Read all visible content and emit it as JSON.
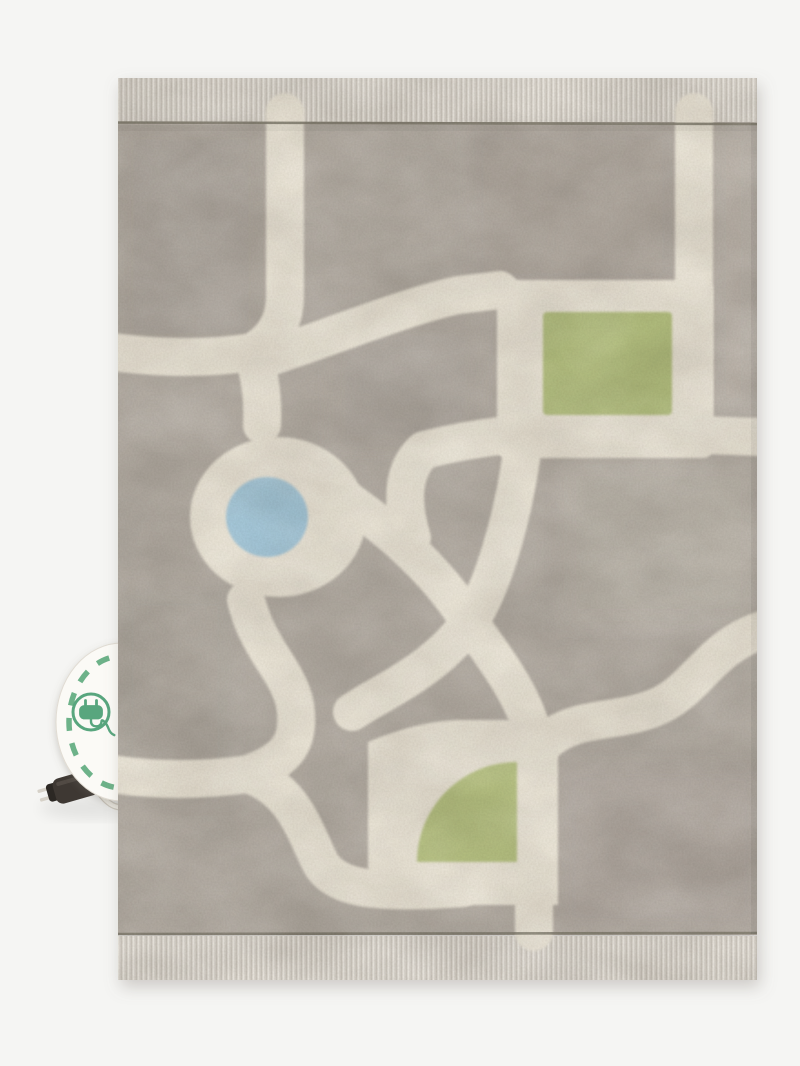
{
  "scene": {
    "type": "product-photo",
    "subject": "Washable grey children's play rug with a city road-map pattern, fringed top and bottom edges, a round white side tag with a green electric-plug icon, and a small dark charging plug on a cable",
    "background_color": "#f5f5f3"
  },
  "rug": {
    "pile_color": "#b5aea5",
    "road_color": "#ece6d8",
    "fringe_color": "#ded9d1",
    "edge_line_color": "#7f7a6c",
    "pond_color": "#a5c8da",
    "park_square_color": "#b4c07f",
    "park_quarter_color": "#b8c383"
  },
  "tag": {
    "fill_color": "#fbfaf6",
    "dash_color": "#6db289",
    "icon": "plug-icon",
    "icon_color": "#58a67e"
  },
  "cable": {
    "cord_color": "#eae7df",
    "plug_color": "#3e3833"
  }
}
